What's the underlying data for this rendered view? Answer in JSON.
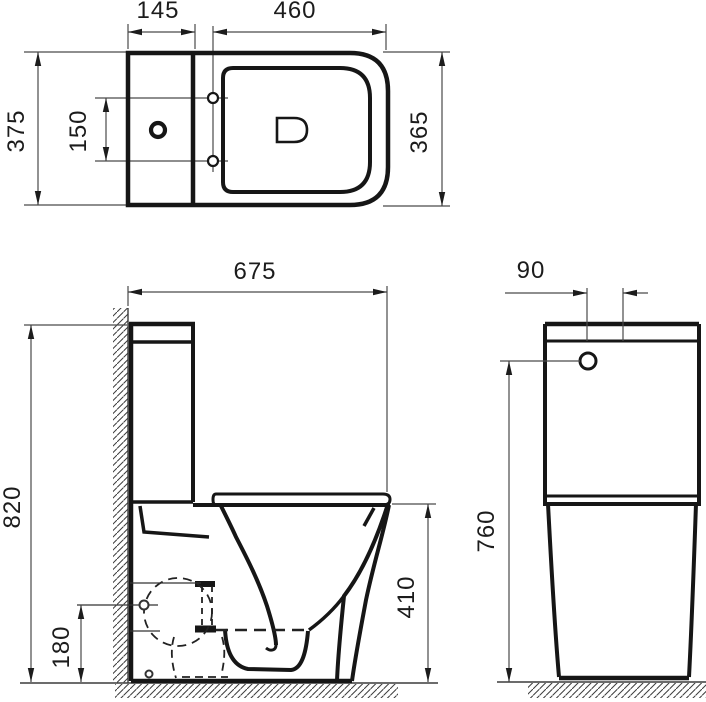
{
  "drawing": {
    "type": "technical-dimension-drawing",
    "subject": "close-coupled toilet, three orthographic views",
    "colors": {
      "object_line": "#161616",
      "dim_line": "#4a4a4a",
      "background": "#ffffff"
    },
    "top_view": {
      "cistern_width": "145",
      "seat_length": "460",
      "overall_width": "375",
      "fixing_hole_centers": "150",
      "pan_width": "365"
    },
    "side_view": {
      "overall_depth": "675",
      "overall_height": "820",
      "outlet_height": "180",
      "bowl_height": "410"
    },
    "rear_view": {
      "inlet_offset": "90",
      "inlet_height": "760"
    }
  }
}
